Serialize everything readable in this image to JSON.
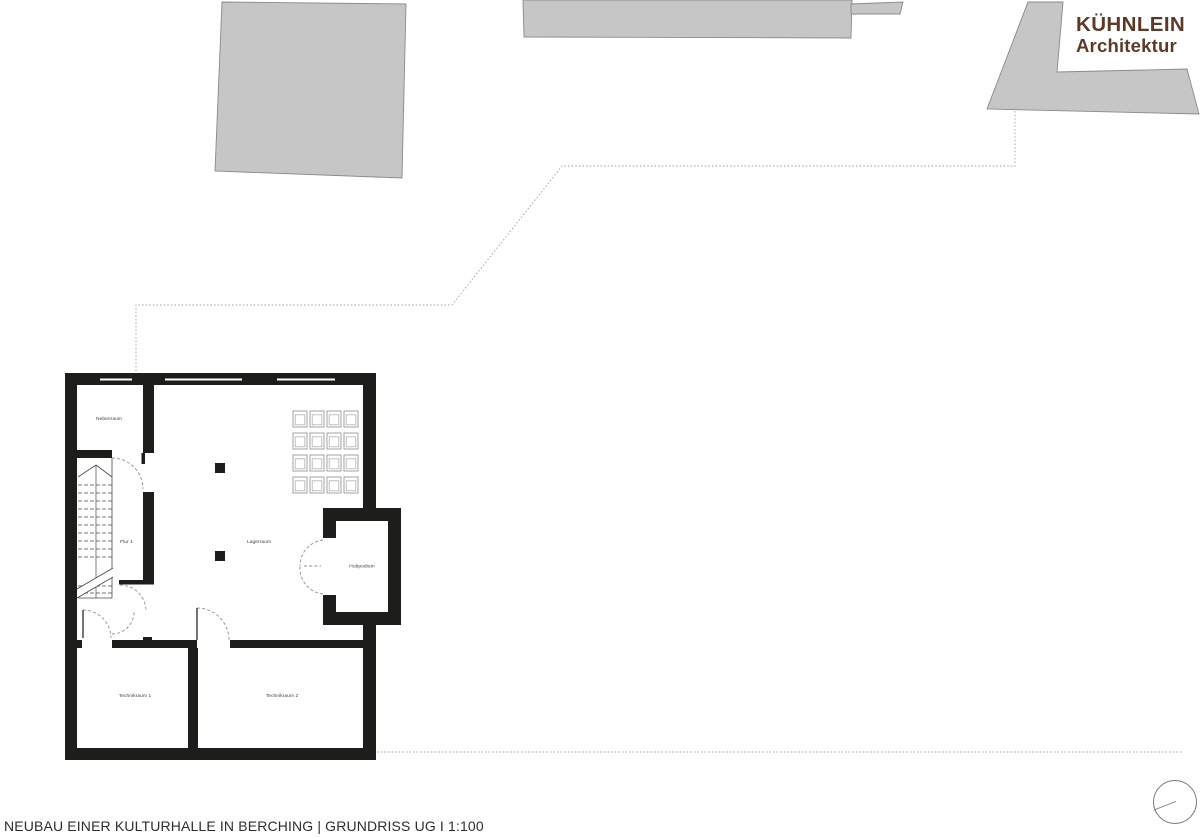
{
  "title_block": {
    "text": "NEUBAU EINER KULTURHALLE IN BERCHING | GRUNDRISS UG I 1:100"
  },
  "logo": {
    "line1": "KÜHNLEIN",
    "line2": "Architektur",
    "color": "#5d3a28"
  },
  "rooms": {
    "nebenraum": {
      "label": "Nebenraum"
    },
    "flur1": {
      "label": "Flur 1"
    },
    "lagerraum": {
      "label": "Lagerraum"
    },
    "hubpodium": {
      "label": "Hubpodium"
    },
    "technikraum1": {
      "label": "Technikraum 1"
    },
    "technikraum2": {
      "label": "Technikraum 2"
    }
  },
  "colors": {
    "wall": "#1d1d1b",
    "neighbor_building_fill": "#c6c6c6",
    "neighbor_building_stroke": "#8a8a8a",
    "site_boundary_dash": "#a3a3a3",
    "door_swing": "#8f8f8f",
    "stair_line": "#4a4a4a",
    "compass_stroke": "#787878",
    "logo_brown": "#5d3a28",
    "title_text": "#2d2d2d"
  }
}
